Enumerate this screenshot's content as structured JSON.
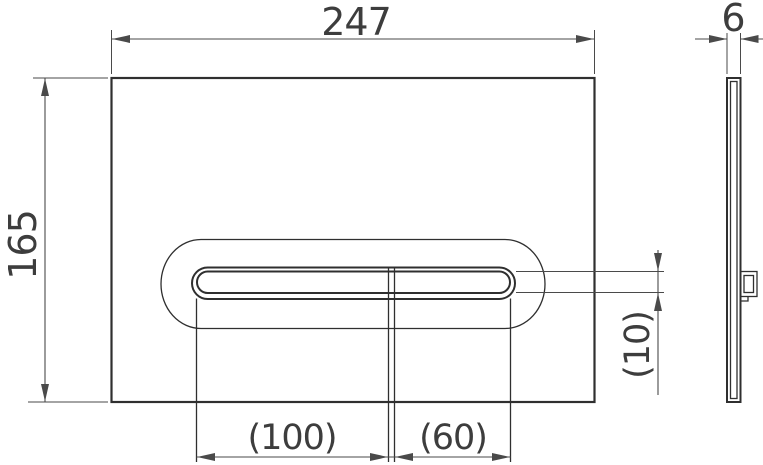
{
  "drawing": {
    "views": {
      "front": "front-view-plate",
      "side": "side-view-profile"
    },
    "dimensions": {
      "overall_width": {
        "value": "247"
      },
      "overall_height": {
        "value": "165"
      },
      "large_button_width": {
        "value": "(100)"
      },
      "small_button_width": {
        "value": "(60)"
      },
      "slot_height": {
        "value": "(10)"
      },
      "thickness": {
        "value": "6"
      }
    },
    "colors": {
      "background": "#ffffff",
      "line": "#2f2f2f",
      "dimension_line": "#4a4a4a",
      "text": "#3d3d3d"
    }
  }
}
